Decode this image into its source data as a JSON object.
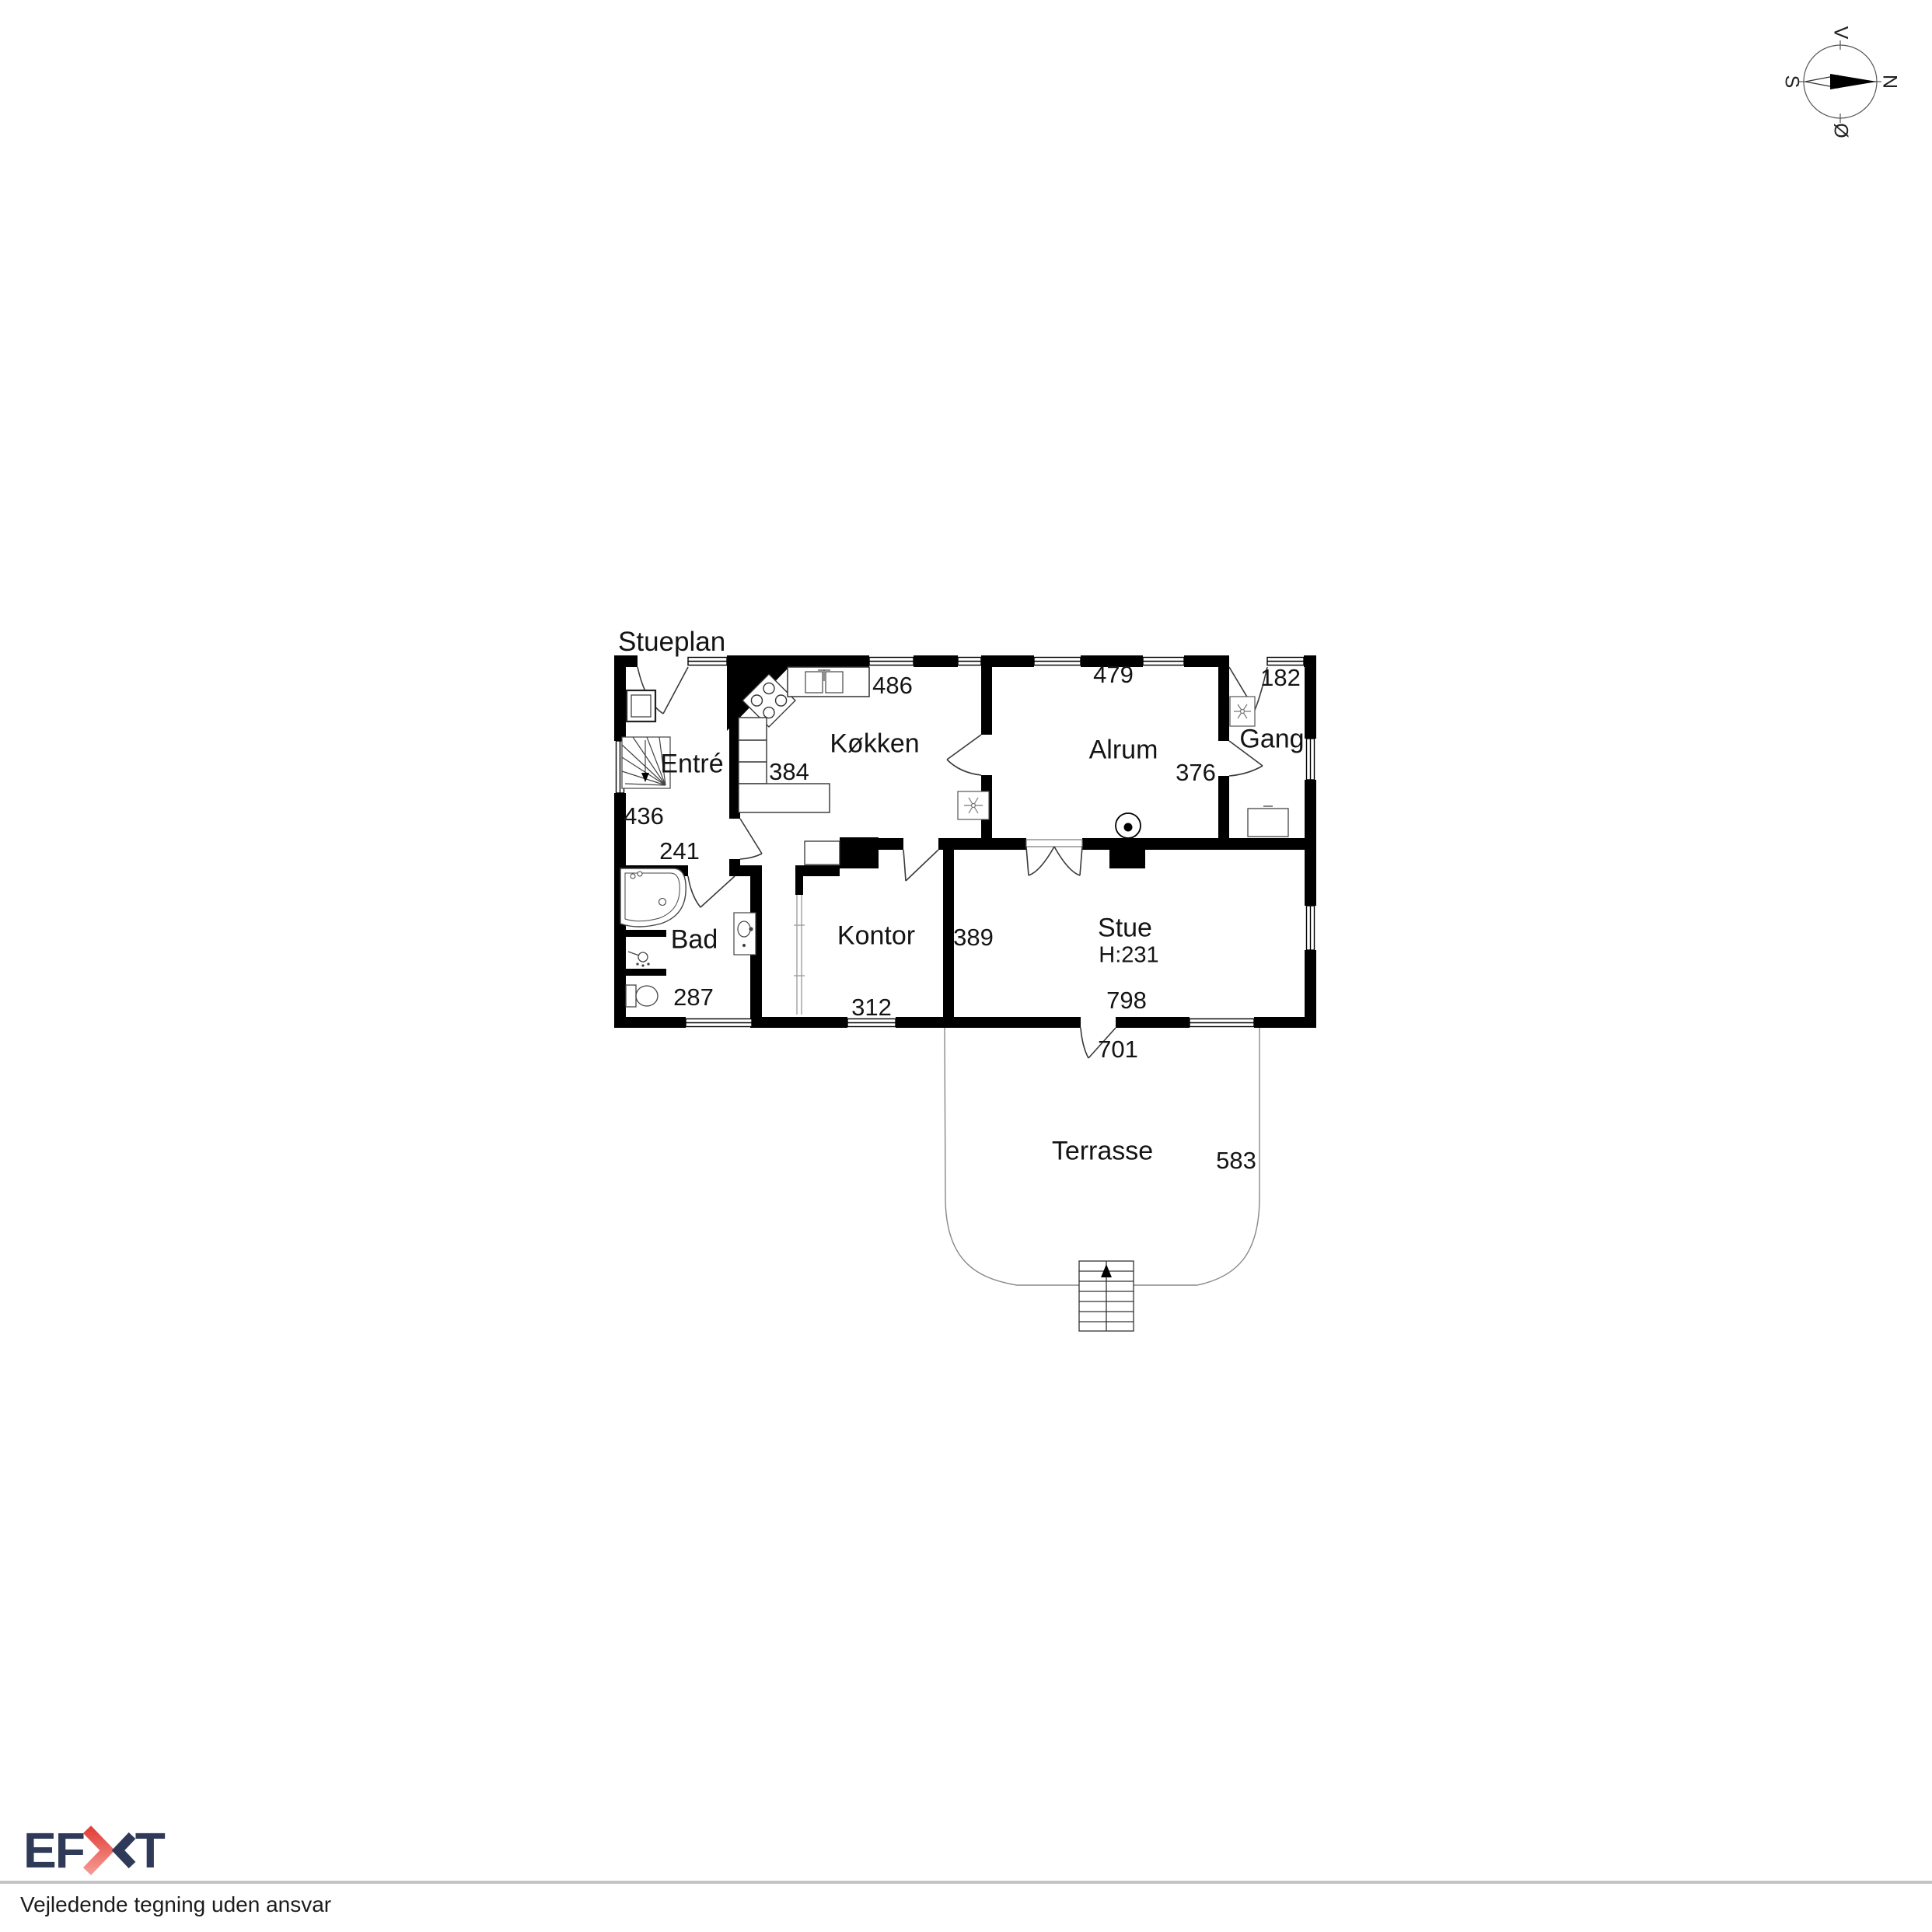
{
  "title": "Stueplan",
  "floorplan": {
    "rooms": [
      {
        "id": "entre",
        "name": "Entré",
        "dims": [
          "436",
          "241"
        ]
      },
      {
        "id": "koekken",
        "name": "Køkken",
        "dims": [
          "486",
          "384"
        ]
      },
      {
        "id": "alrum",
        "name": "Alrum",
        "dims": [
          "479",
          "376"
        ]
      },
      {
        "id": "gang",
        "name": "Gang",
        "dims": [
          "182"
        ]
      },
      {
        "id": "bad",
        "name": "Bad",
        "dims": [
          "287"
        ]
      },
      {
        "id": "kontor",
        "name": "Kontor",
        "dims": [
          "312",
          "389"
        ]
      },
      {
        "id": "stue",
        "name": "Stue",
        "ceiling_height": "H:231",
        "dims": [
          "798",
          "701"
        ]
      },
      {
        "id": "terrasse",
        "name": "Terrasse",
        "dims": [
          "583"
        ]
      }
    ]
  },
  "compass": {
    "north": "N",
    "west": "V",
    "south": "S",
    "east": "Ø"
  },
  "footer": {
    "logo": {
      "text": "EFKT",
      "left": "EF",
      "right": "T"
    },
    "disclaimer": "Vejledende tegning uden ansvar",
    "colors": {
      "navy": "#2f3a59",
      "red": "#e2423d"
    }
  }
}
